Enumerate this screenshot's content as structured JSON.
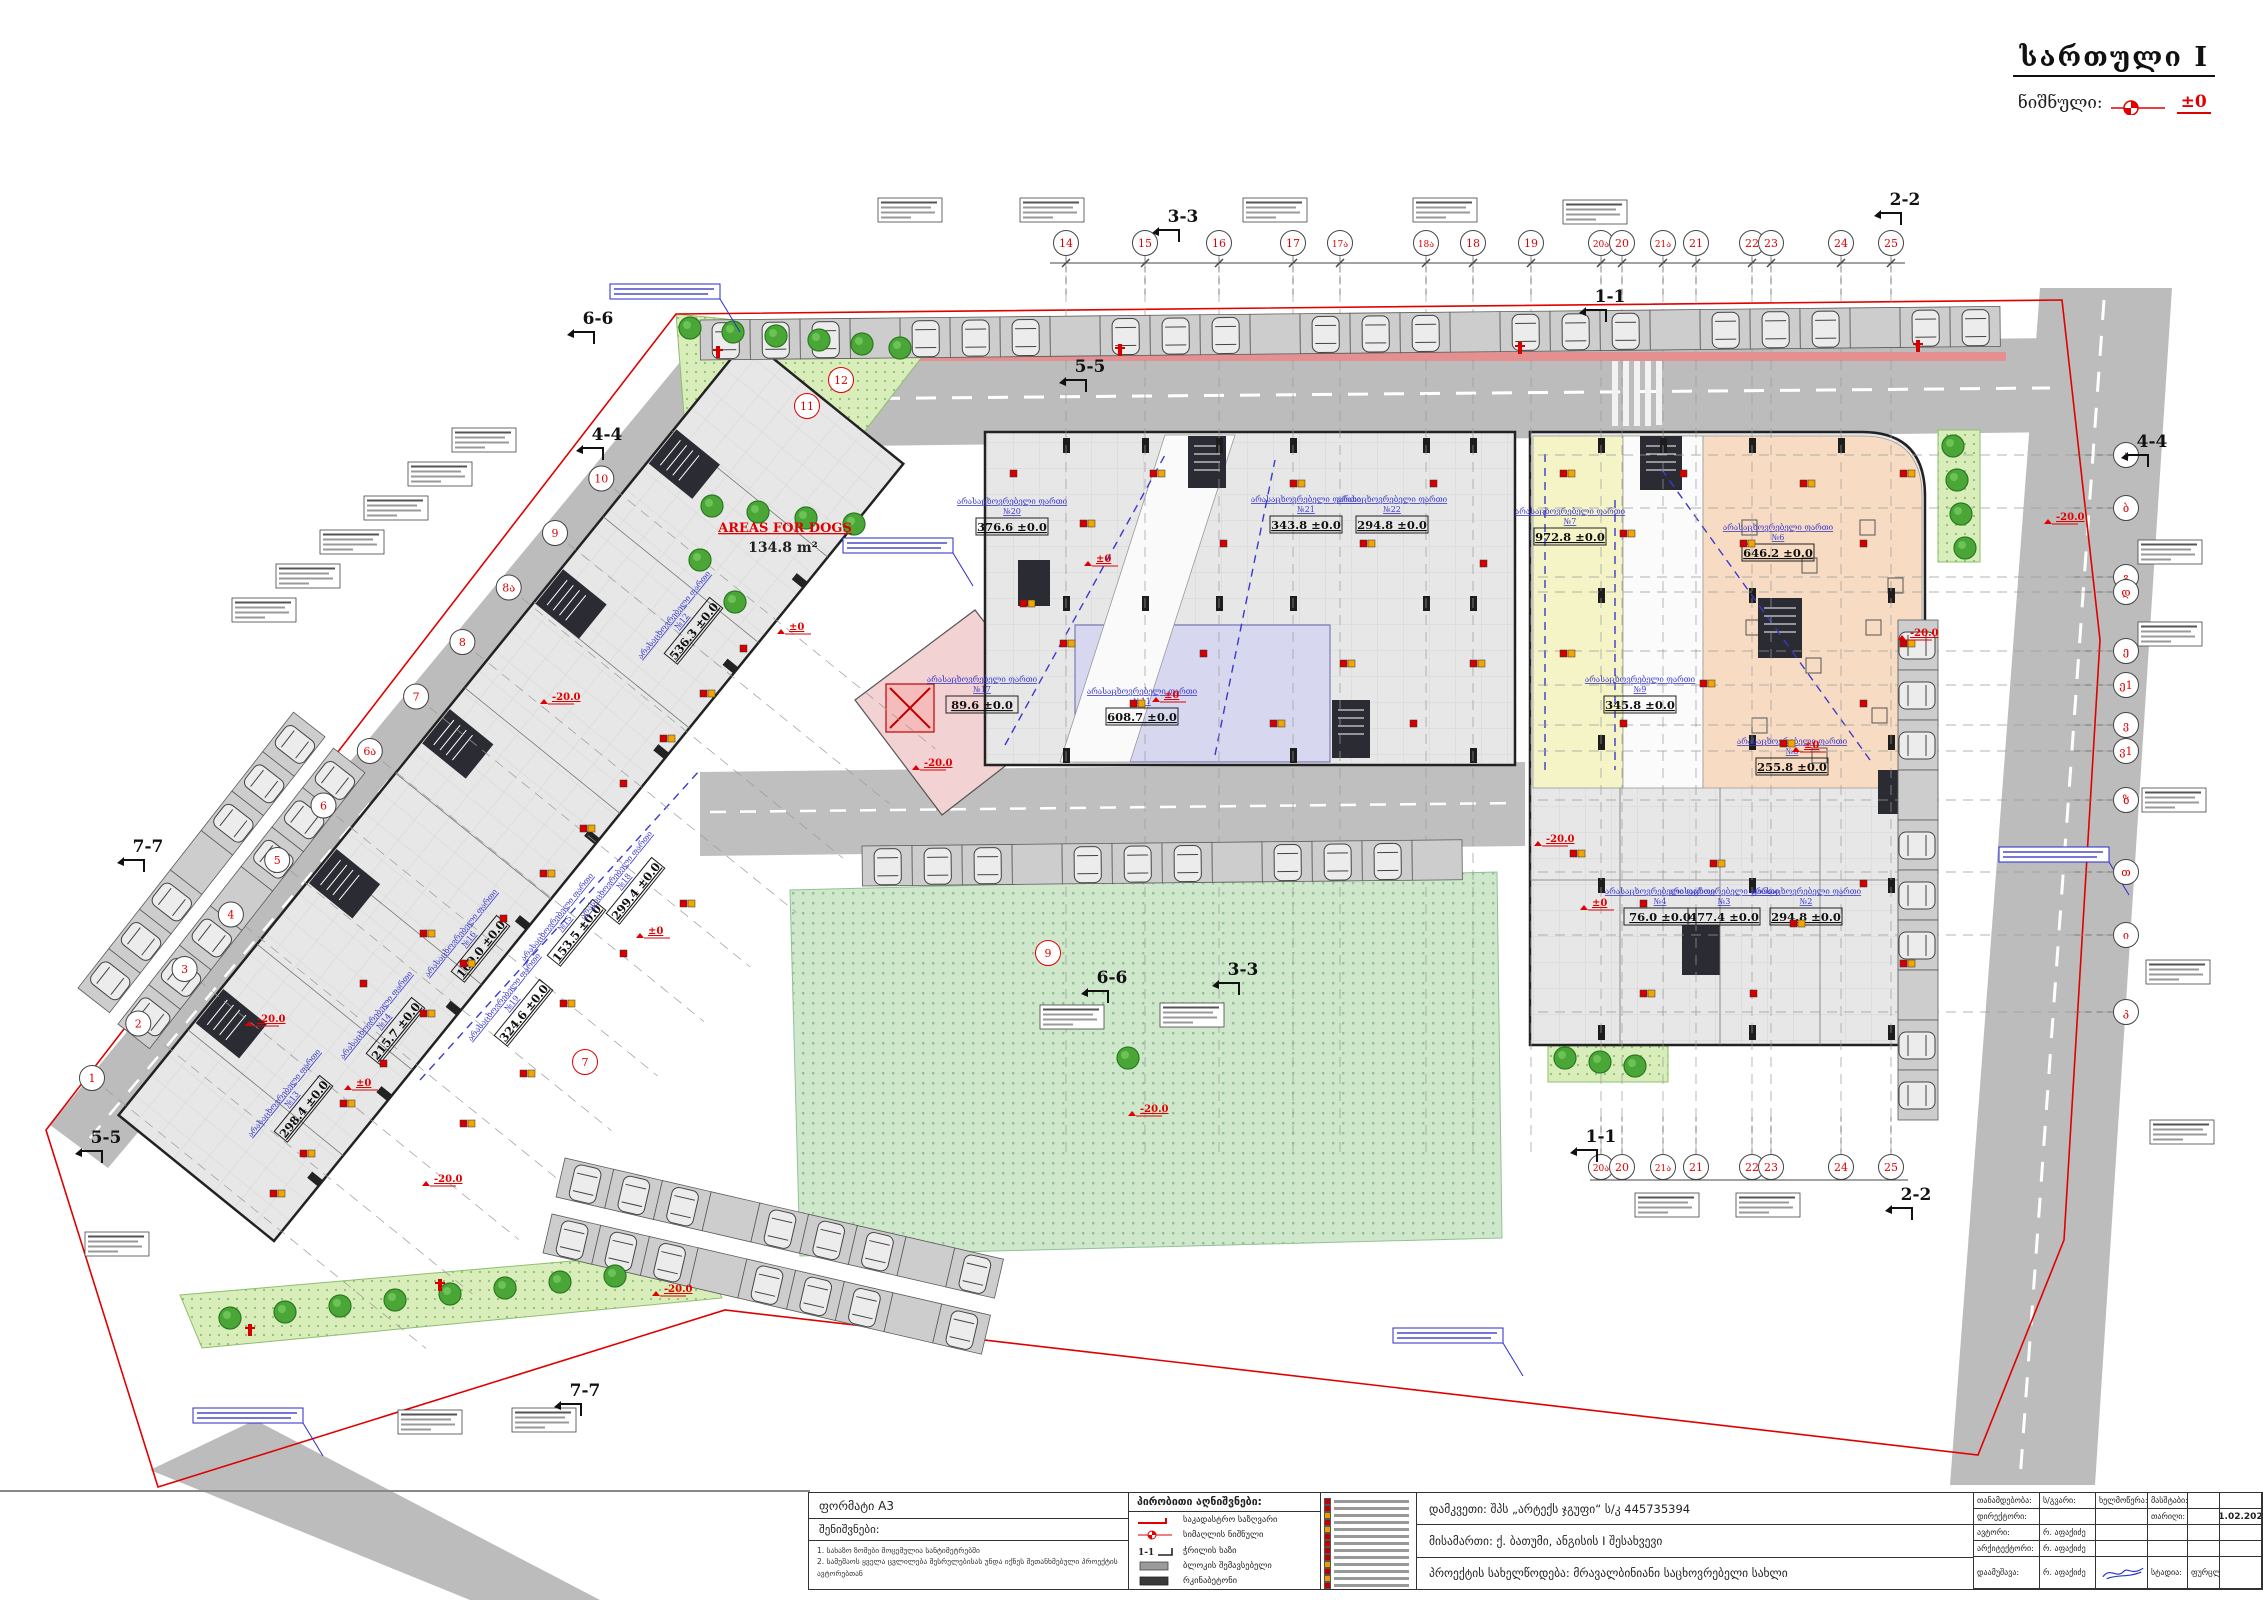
{
  "sheet": {
    "title": "სართული I",
    "level_label": "ნიშნული:",
    "level_value": "±0"
  },
  "dogs": {
    "title": "AREAS FOR DOGS",
    "area": "134.8 m²"
  },
  "titleblock": {
    "format_label": "ფორმატი A3",
    "notes_header": "შენიშვნები:",
    "note1": "1. სახაზო ზომები მოცემულია სანტიმეტრებში",
    "note2": "2. სამუშაოს ყველა ცვლილება შესრულებისას უნდა იქნეს შეთანხმებული პროექტის ავტორებთან",
    "legend_header": "პირობითი აღნიშვნები:",
    "legend": [
      {
        "symbol": "cadastral-boundary-line",
        "label": "საკადასტრო საზღვარი"
      },
      {
        "symbol": "level-mark",
        "label": "სიმაღლის ნიშნული"
      },
      {
        "symbol": "section-line",
        "label": "ჭრილის ხაზი"
      },
      {
        "symbol": "block-fill",
        "label": "ბლოკის შემავსებელი"
      },
      {
        "symbol": "concrete-fill",
        "label": "რკინაბეტონი"
      }
    ],
    "fire_legend_colors": [
      "#c00000",
      "#c00000",
      "#e8a000",
      "#c00000",
      "#e8a000",
      "#c00000",
      "#c00000",
      "#c00000",
      "#c00000",
      "#e8a000",
      "#c00000",
      "#e8a000",
      "#c00000"
    ],
    "client": "დამკვეთი:  შპს „არტექს ჯგუფი“ ს/კ 445735394",
    "address": "მისამართი: ქ. ბათუმი, ანგისის I შესახვევი",
    "project": "პროექტის სახელწოდება: მრავალბინიანი საცხოვრებელი სახლი",
    "col_position": "თანამდებობა:",
    "col_name": "ს/გვარი:",
    "col_sign": "ხელმოწერა:",
    "col_scale": "მასშტაბი:",
    "col_date": "თარიღი:",
    "date": "21.02.2025",
    "row_director": "დირექტორი:",
    "row_author": "ავტორი:",
    "row_architect": "არქიტექტორი:",
    "row_developed": "დაამუშავა:",
    "name": "რ. აფაქიძე",
    "stage_label": "სტადია:",
    "sheets_label": "ფურცლები:"
  },
  "plan": {
    "bubbles_top": [
      {
        "n": "14",
        "x": 1066
      },
      {
        "n": "15",
        "x": 1145
      },
      {
        "n": "16",
        "x": 1219
      },
      {
        "n": "17",
        "x": 1293
      },
      {
        "n": "17ა",
        "x": 1340
      },
      {
        "n": "18ა",
        "x": 1426
      },
      {
        "n": "18",
        "x": 1473
      },
      {
        "n": "19",
        "x": 1531
      },
      {
        "n": "20ა",
        "x": 1601
      },
      {
        "n": "20",
        "x": 1622
      },
      {
        "n": "21ა",
        "x": 1663
      },
      {
        "n": "21",
        "x": 1696
      },
      {
        "n": "22",
        "x": 1752
      },
      {
        "n": "23",
        "x": 1771
      },
      {
        "n": "24",
        "x": 1841
      },
      {
        "n": "25",
        "x": 1891
      }
    ],
    "bubbles_top_y": 243,
    "bubbles_bottom": [
      {
        "n": "20ა",
        "x": 1601
      },
      {
        "n": "20",
        "x": 1622
      },
      {
        "n": "21ა",
        "x": 1663
      },
      {
        "n": "21",
        "x": 1696
      },
      {
        "n": "22",
        "x": 1752
      },
      {
        "n": "23",
        "x": 1771
      },
      {
        "n": "24",
        "x": 1841
      },
      {
        "n": "25",
        "x": 1891
      }
    ],
    "bubbles_bottom_y": 1167,
    "bubbles_right": [
      {
        "n": "ა",
        "y": 455
      },
      {
        "n": "ბ",
        "y": 508
      },
      {
        "n": "გ",
        "y": 577
      },
      {
        "n": "დ",
        "y": 592
      },
      {
        "n": "ე",
        "y": 651
      },
      {
        "n": "ე1",
        "y": 685
      },
      {
        "n": "ვ",
        "y": 725
      },
      {
        "n": "ვ1",
        "y": 751
      },
      {
        "n": "ზ",
        "y": 800
      },
      {
        "n": "თ",
        "y": 872
      },
      {
        "n": "ი",
        "y": 935
      },
      {
        "n": "კ",
        "y": 1012
      }
    ],
    "bubbles_right_x": 2126,
    "bubbles_diag": [
      "1",
      "2",
      "3",
      "4",
      "5",
      "6",
      "6ა",
      "7",
      "8",
      "8ა",
      "9",
      "10"
    ],
    "bubbles_diag_start": [
      92,
      1078
    ],
    "bubbles_diag_step": [
      46.3,
      -54.5
    ],
    "red_circles": [
      {
        "n": "9",
        "x": 1048,
        "y": 953
      },
      {
        "n": "11",
        "x": 807,
        "y": 406
      },
      {
        "n": "12",
        "x": 841,
        "y": 380
      },
      {
        "n": "7",
        "x": 585,
        "y": 1062
      }
    ],
    "sections": [
      {
        "t": "3-3",
        "x": 1183,
        "y": 222
      },
      {
        "t": "2-2",
        "x": 1905,
        "y": 205
      },
      {
        "t": "1-1",
        "x": 1610,
        "y": 302
      },
      {
        "t": "5-5",
        "x": 1090,
        "y": 372
      },
      {
        "t": "6-6",
        "x": 598,
        "y": 324
      },
      {
        "t": "4-4",
        "x": 607,
        "y": 440
      },
      {
        "t": "4-4",
        "x": 2152,
        "y": 447
      },
      {
        "t": "7-7",
        "x": 148,
        "y": 852
      },
      {
        "t": "5-5",
        "x": 106,
        "y": 1143
      },
      {
        "t": "7-7",
        "x": 585,
        "y": 1396
      },
      {
        "t": "6-6",
        "x": 1112,
        "y": 983
      },
      {
        "t": "3-3",
        "x": 1243,
        "y": 975
      },
      {
        "t": "1-1",
        "x": 1601,
        "y": 1142
      },
      {
        "t": "2-2",
        "x": 1916,
        "y": 1200
      }
    ],
    "area_labels": [
      {
        "x": 1012,
        "y": 522,
        "r": 0,
        "n": "№20",
        "a": "376.6 ±0.0"
      },
      {
        "x": 1306,
        "y": 520,
        "r": 0,
        "n": "№21",
        "a": "343.8 ±0.0"
      },
      {
        "x": 1392,
        "y": 520,
        "r": 0,
        "n": "№22",
        "a": "294.8 ±0.0"
      },
      {
        "x": 1570,
        "y": 532,
        "r": 0,
        "n": "№7",
        "a": "972.8 ±0.0"
      },
      {
        "x": 1778,
        "y": 548,
        "r": 0,
        "n": "№6",
        "a": "646.2 ±0.0"
      },
      {
        "x": 982,
        "y": 700,
        "r": 0,
        "n": "№17",
        "a": "89.6 ±0.0"
      },
      {
        "x": 1142,
        "y": 712,
        "r": 0,
        "n": "№11",
        "a": "608.7 ±0.0"
      },
      {
        "x": 1640,
        "y": 700,
        "r": 0,
        "n": "№9",
        "a": "345.8 ±0.0"
      },
      {
        "x": 1792,
        "y": 762,
        "r": 0,
        "n": "№8",
        "a": "255.8 ±0.0"
      },
      {
        "x": 1660,
        "y": 912,
        "r": 0,
        "n": "№4",
        "a": "76.0 ±0.0"
      },
      {
        "x": 1724,
        "y": 912,
        "r": 0,
        "n": "№3",
        "a": "477.4 ±0.0"
      },
      {
        "x": 1806,
        "y": 912,
        "r": 0,
        "n": "№2",
        "a": "294.8 ±0.0"
      },
      {
        "x": 477,
        "y": 946,
        "r": -51,
        "n": "№16",
        "a": "169.0 ±0.0"
      },
      {
        "x": 573,
        "y": 930,
        "r": -51,
        "n": "№15",
        "a": "153.5 ±0.0"
      },
      {
        "x": 632,
        "y": 888,
        "r": -51,
        "n": "№18",
        "a": "299.4 ±0.0"
      },
      {
        "x": 392,
        "y": 1028,
        "r": -51,
        "n": "№14",
        "a": "215.7 ±0.0"
      },
      {
        "x": 300,
        "y": 1106,
        "r": -51,
        "n": "№13",
        "a": "298.4 ±0.0"
      },
      {
        "x": 520,
        "y": 1010,
        "r": -51,
        "n": "№19",
        "a": "324.6 ±0.0"
      },
      {
        "x": 690,
        "y": 628,
        "r": -51,
        "n": "№12",
        "a": "536.3 ±0.0"
      }
    ],
    "area_label_line1": "არასაცხოვრებელი ფართი",
    "level_marks": [
      {
        "t": "-20.0",
        "x": 920,
        "y": 766
      },
      {
        "t": "-20.0",
        "x": 548,
        "y": 700
      },
      {
        "t": "-20.0",
        "x": 1542,
        "y": 842
      },
      {
        "t": "-20.0",
        "x": 2052,
        "y": 520
      },
      {
        "t": "-20.0",
        "x": 253,
        "y": 1022
      },
      {
        "t": "-20.0",
        "x": 660,
        "y": 1292
      },
      {
        "t": "-20.0",
        "x": 1906,
        "y": 636
      },
      {
        "t": "-20.0",
        "x": 1136,
        "y": 1112
      },
      {
        "t": "-20.0",
        "x": 430,
        "y": 1182
      },
      {
        "t": "±0",
        "x": 1160,
        "y": 698
      },
      {
        "t": "±0",
        "x": 1800,
        "y": 748
      },
      {
        "t": "±0",
        "x": 644,
        "y": 934
      },
      {
        "t": "±0",
        "x": 352,
        "y": 1086
      },
      {
        "t": "±0",
        "x": 1588,
        "y": 906
      },
      {
        "t": "±0",
        "x": 1092,
        "y": 562
      },
      {
        "t": "±0",
        "x": 785,
        "y": 630
      }
    ],
    "ann_boxes": [
      [
        878,
        198
      ],
      [
        1020,
        198
      ],
      [
        1243,
        198
      ],
      [
        1413,
        198
      ],
      [
        1563,
        200
      ],
      [
        2138,
        540
      ],
      [
        2138,
        622
      ],
      [
        2142,
        788
      ],
      [
        2146,
        960
      ],
      [
        2150,
        1120
      ],
      [
        452,
        428
      ],
      [
        408,
        462
      ],
      [
        364,
        496
      ],
      [
        320,
        530
      ],
      [
        276,
        564
      ],
      [
        232,
        598
      ],
      [
        1635,
        1193
      ],
      [
        1736,
        1193
      ],
      [
        398,
        1410
      ],
      [
        512,
        1408
      ],
      [
        1040,
        1005
      ],
      [
        1160,
        1003
      ],
      [
        85,
        1232
      ]
    ],
    "blue_notes": [
      [
        610,
        284
      ],
      [
        843,
        538
      ],
      [
        193,
        1408
      ],
      [
        1393,
        1328
      ],
      [
        1999,
        847
      ]
    ],
    "fire_icons": [
      [
        300,
        1150
      ],
      [
        340,
        1100
      ],
      [
        380,
        1060
      ],
      [
        420,
        1010
      ],
      [
        460,
        960
      ],
      [
        500,
        915
      ],
      [
        540,
        870
      ],
      [
        580,
        825
      ],
      [
        620,
        780
      ],
      [
        660,
        735
      ],
      [
        700,
        690
      ],
      [
        740,
        645
      ],
      [
        460,
        1120
      ],
      [
        520,
        1070
      ],
      [
        360,
        980
      ],
      [
        420,
        930
      ],
      [
        560,
        1000
      ],
      [
        620,
        950
      ],
      [
        680,
        900
      ],
      [
        270,
        1190
      ],
      [
        1010,
        470
      ],
      [
        1080,
        520
      ],
      [
        1150,
        470
      ],
      [
        1220,
        540
      ],
      [
        1290,
        480
      ],
      [
        1360,
        540
      ],
      [
        1430,
        480
      ],
      [
        1060,
        640
      ],
      [
        1130,
        700
      ],
      [
        1200,
        650
      ],
      [
        1270,
        720
      ],
      [
        1340,
        660
      ],
      [
        1410,
        720
      ],
      [
        1470,
        660
      ],
      [
        1020,
        600
      ],
      [
        1480,
        560
      ],
      [
        1560,
        470
      ],
      [
        1620,
        530
      ],
      [
        1680,
        470
      ],
      [
        1740,
        540
      ],
      [
        1800,
        480
      ],
      [
        1860,
        540
      ],
      [
        1900,
        470
      ],
      [
        1560,
        650
      ],
      [
        1620,
        720
      ],
      [
        1700,
        680
      ],
      [
        1780,
        740
      ],
      [
        1860,
        700
      ],
      [
        1900,
        640
      ],
      [
        1570,
        850
      ],
      [
        1640,
        900
      ],
      [
        1710,
        860
      ],
      [
        1790,
        920
      ],
      [
        1860,
        880
      ],
      [
        1900,
        960
      ],
      [
        1640,
        990
      ],
      [
        1750,
        990
      ]
    ],
    "hydrants": [
      [
        718,
        352
      ],
      [
        1120,
        350
      ],
      [
        1520,
        348
      ],
      [
        1918,
        346
      ],
      [
        440,
        1285
      ],
      [
        250,
        1330
      ]
    ],
    "trees": [
      [
        690,
        328
      ],
      [
        733,
        332
      ],
      [
        776,
        336
      ],
      [
        819,
        340
      ],
      [
        862,
        344
      ],
      [
        900,
        348
      ],
      [
        712,
        506
      ],
      [
        758,
        512
      ],
      [
        806,
        518
      ],
      [
        854,
        524
      ],
      [
        700,
        560
      ],
      [
        735,
        602
      ],
      [
        230,
        1318
      ],
      [
        285,
        1312
      ],
      [
        340,
        1306
      ],
      [
        395,
        1300
      ],
      [
        450,
        1294
      ],
      [
        505,
        1288
      ],
      [
        560,
        1282
      ],
      [
        615,
        1276
      ],
      [
        1953,
        446
      ],
      [
        1957,
        480
      ],
      [
        1961,
        514
      ],
      [
        1965,
        548
      ],
      [
        1565,
        1058
      ],
      [
        1600,
        1062
      ],
      [
        1635,
        1066
      ],
      [
        1128,
        1058
      ]
    ],
    "parking_rows": [
      {
        "x": 700,
        "y": 320,
        "r": -0.6,
        "n": 26
      },
      {
        "x": 1938,
        "y": 620,
        "r": 90,
        "n": 10
      },
      {
        "x": 862,
        "y": 846,
        "r": -0.6,
        "n": 12
      },
      {
        "x": 565,
        "y": 1158,
        "r": 13,
        "n": 9
      },
      {
        "x": 552,
        "y": 1214,
        "r": 13,
        "n": 9
      },
      {
        "x": 78,
        "y": 988,
        "r": -52,
        "n": 7
      },
      {
        "x": 118,
        "y": 1024,
        "r": -52,
        "n": 7
      }
    ]
  }
}
